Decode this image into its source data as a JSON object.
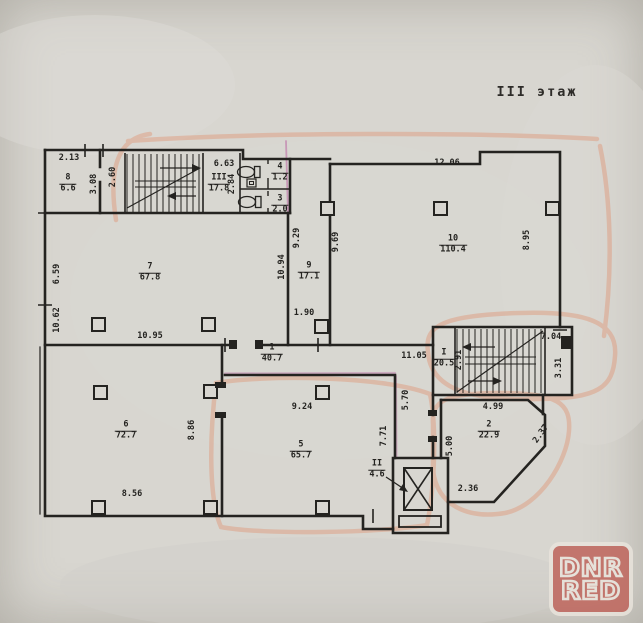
{
  "title": "III этаж",
  "watermark": {
    "line1": "DNR",
    "line2": "RED"
  },
  "colors": {
    "paper": "#d8d6d0",
    "ink": "#242320",
    "highlight": "#e08e6c",
    "marker_pink": "#b85a9e",
    "logo_red": "#bf655c"
  },
  "rooms": [
    {
      "num": "8",
      "area": "6.6"
    },
    {
      "num": "III",
      "area": "17.8"
    },
    {
      "num": "4",
      "area": "1.2"
    },
    {
      "num": "3",
      "area": "2.0"
    },
    {
      "num": "7",
      "area": "67.8"
    },
    {
      "num": "9",
      "area": "17.1"
    },
    {
      "num": "10",
      "area": "110.4"
    },
    {
      "num": "1",
      "area": "40.7"
    },
    {
      "num": "6",
      "area": "72.7"
    },
    {
      "num": "5",
      "area": "65.7"
    },
    {
      "num": "I",
      "area": "20.5"
    },
    {
      "num": "2",
      "area": "22.9"
    },
    {
      "num": "II",
      "area": "4.6"
    }
  ],
  "dims": [
    "2.13",
    "3.08",
    "2.60",
    "6.63",
    "2.84",
    "12.06",
    "9.29",
    "9.69",
    "10.94",
    "6.59",
    "10.62",
    "10.95",
    "1.90",
    "8.95",
    "11.05",
    "9.24",
    "8.86",
    "8.56",
    "7.71",
    "5.70",
    "2.91",
    "7.04",
    "3.31",
    "4.99",
    "5.00",
    "2.37",
    "2.36"
  ]
}
